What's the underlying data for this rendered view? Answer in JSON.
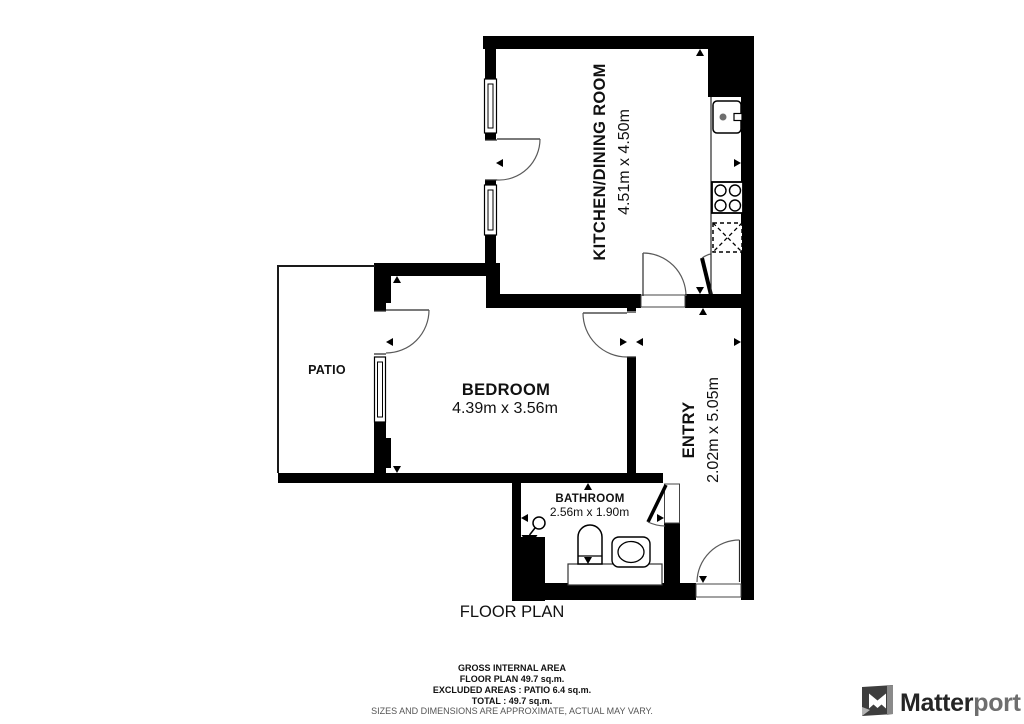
{
  "plan": {
    "title": "FLOOR PLAN",
    "rooms": {
      "kitchen": {
        "name": "KITCHEN/DINING ROOM",
        "dims": "4.51m x 4.50m"
      },
      "bedroom": {
        "name": "BEDROOM",
        "dims": "4.39m x 3.56m"
      },
      "entry": {
        "name": "ENTRY",
        "dims": "2.02m x 5.05m"
      },
      "bathroom": {
        "name": "BATHROOM",
        "dims": "2.56m x 1.90m"
      },
      "patio": {
        "name": "PATIO"
      }
    }
  },
  "footer": {
    "line1": "GROSS INTERNAL AREA",
    "line2": "FLOOR PLAN 49.7 sq.m.",
    "line3": "EXCLUDED AREAS :  PATIO 6.4 sq.m.",
    "line4": "TOTAL :  49.7 sq.m.",
    "disclaimer": "SIZES AND DIMENSIONS ARE APPROXIMATE, ACTUAL MAY VARY."
  },
  "branding": {
    "name_primary": "Matter",
    "name_secondary": "port"
  },
  "colors": {
    "wall": "#000000",
    "door_arc": "#5a5a5a",
    "disclaimer_text": "#555555",
    "logo_primary": "#252525",
    "logo_secondary": "#6e6e6e"
  }
}
